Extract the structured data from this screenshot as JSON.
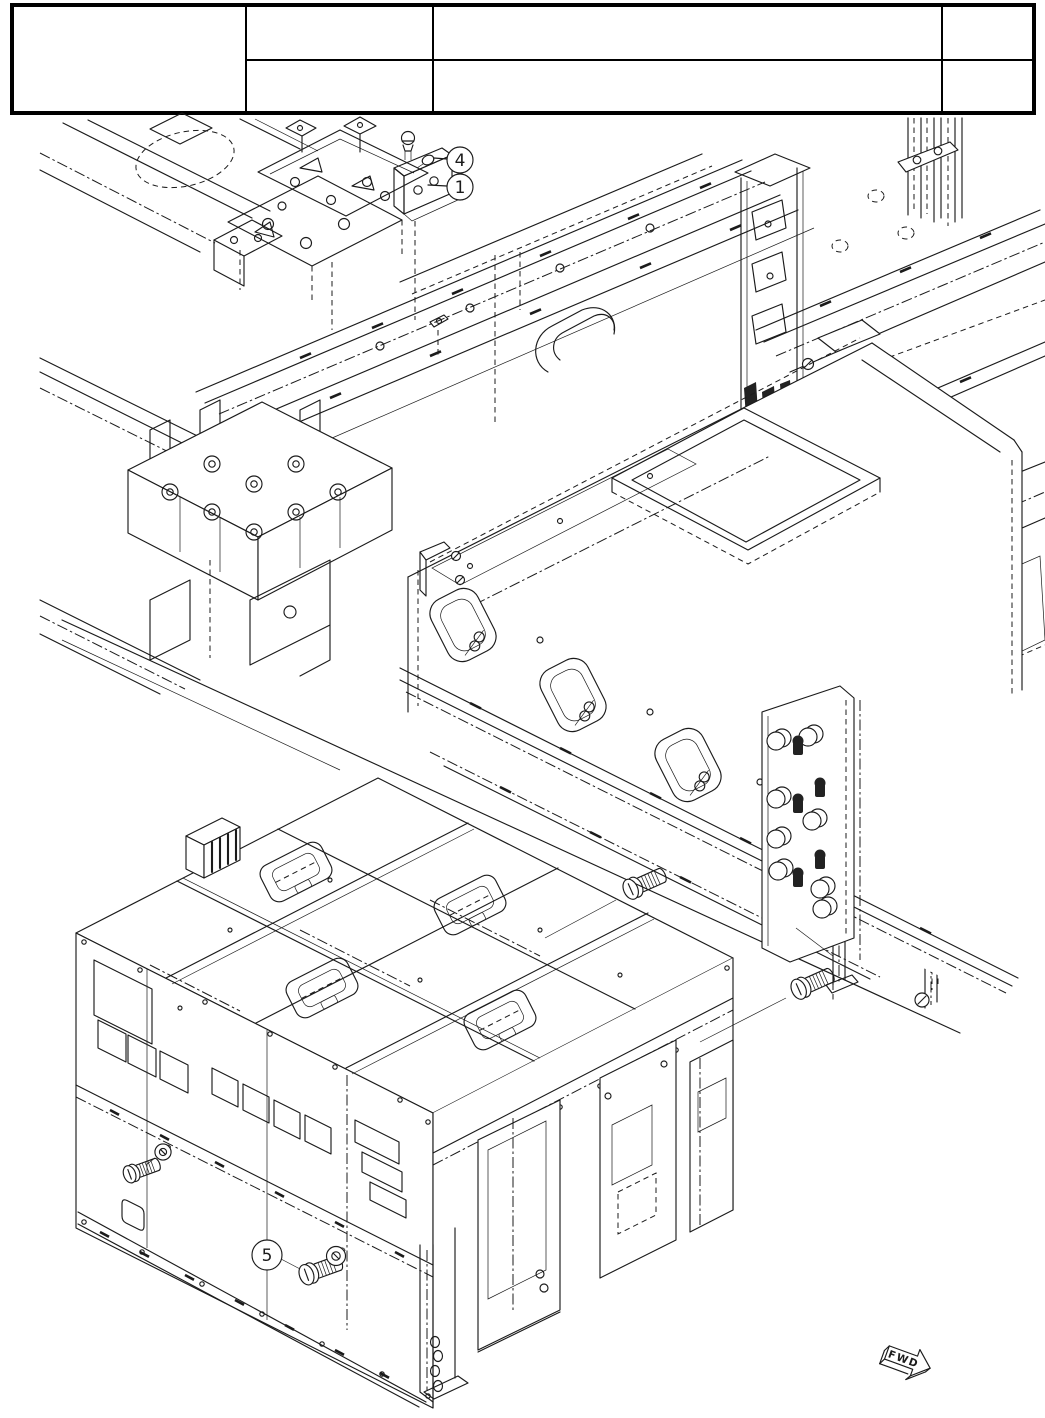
{
  "colors": {
    "ink": "#1b1b1b",
    "paper": "#ffffff"
  },
  "header_table": {
    "left_cell": "",
    "col2_top": "",
    "col2_bottom": "",
    "col3_top": "",
    "col3_bottom": "",
    "col4_top": "",
    "col4_bottom": ""
  },
  "diagram": {
    "callouts": [
      {
        "label": "4"
      },
      {
        "label": "1"
      },
      {
        "label": "5"
      }
    ],
    "direction_arrow_label": "FWD"
  }
}
